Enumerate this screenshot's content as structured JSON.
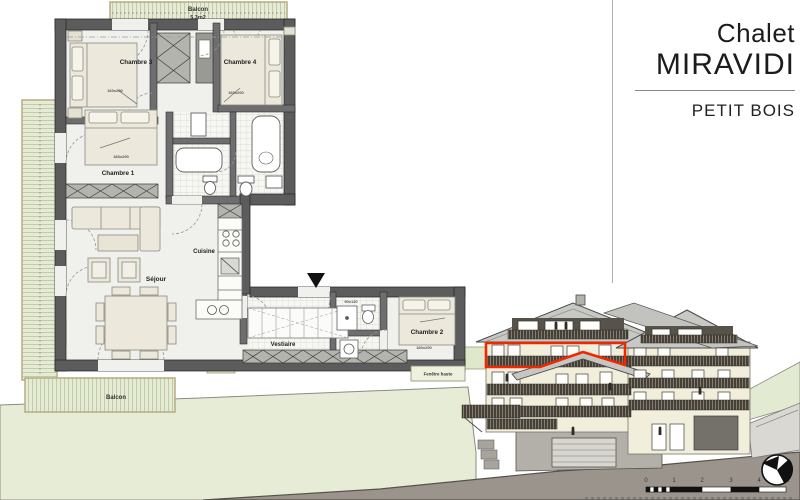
{
  "title_block": {
    "project": "Chalet",
    "project_name": "MIRAVIDI",
    "unit_name": "PETIT BOIS"
  },
  "floor_plan": {
    "balcony_top": {
      "label": "Balcon",
      "area": "5,3m2"
    },
    "balcony_bottom_label": "Balcon",
    "rooms": {
      "chambre1": {
        "label": "Chambre 1",
        "bed": "180x200"
      },
      "chambre2": {
        "label": "Chambre 2",
        "bed": "180x200"
      },
      "chambre3": {
        "label": "Chambre 3",
        "bed": "160x200"
      },
      "chambre4": {
        "label": "Chambre 4",
        "bed": "160x200"
      },
      "sejour": {
        "label": "Séjour"
      },
      "cuisine": {
        "label": "Cuisine"
      },
      "vestiaire": {
        "label": "Vestiaire"
      }
    },
    "annotations": {
      "high_window": "Fenêtre haute",
      "shower": "90x120"
    }
  },
  "elevation": {
    "scale_labels": [
      "0",
      "1",
      "2",
      "3",
      "4",
      "5M"
    ]
  },
  "colors": {
    "highlight_red": "#f02800",
    "balcony_green": "#e6ebd6",
    "hill_green": "#e7ecd6",
    "ground_brown": "#9b948c",
    "wall_cream": "#f1efdc"
  }
}
